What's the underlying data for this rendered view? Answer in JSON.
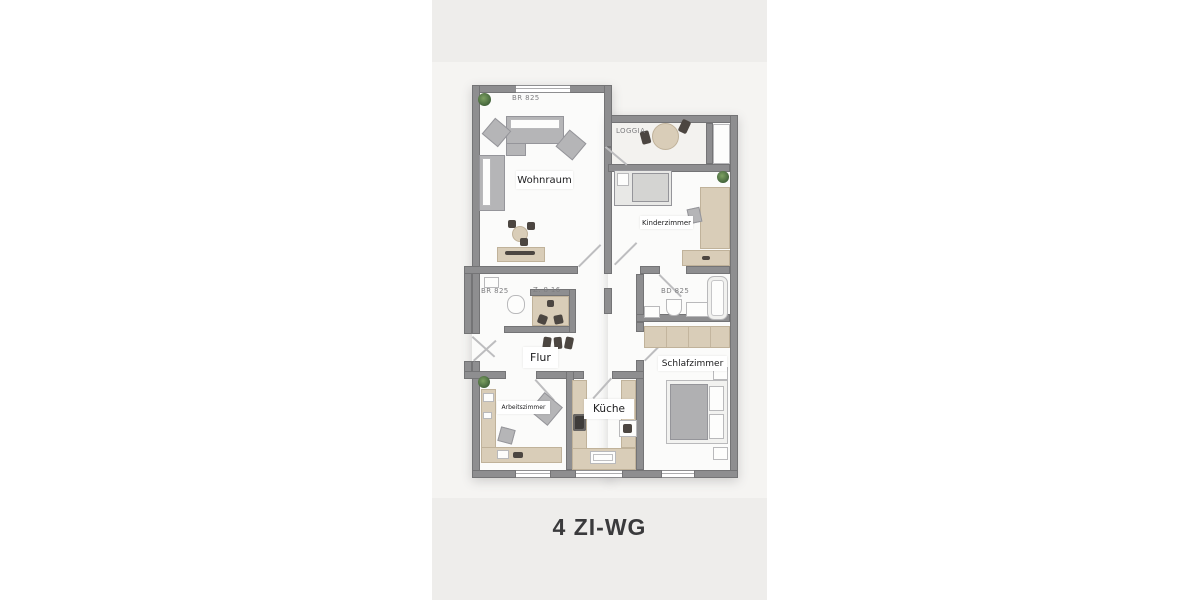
{
  "title": "4 ZI-WG",
  "rooms": {
    "wohnraum": "Wohnraum",
    "kinderzimmer": "Kinderzimmer",
    "flur": "Flur",
    "schlafzimmer": "Schlafzimmer",
    "kueche": "Küche",
    "arbeitszimmer": "Arbeitszimmer"
  },
  "annotations": {
    "loggia": "LOGGIA",
    "br825_top": "BR 825",
    "br825_mid": "BR 825",
    "z816": "Z. 8 16",
    "bd825": "BD 825"
  },
  "colors": {
    "page_bg": "#ffffff",
    "panel_bg": "#eeedeb",
    "plan_bg": "#f5f4f2",
    "wall": "#8e8e90",
    "floor": "#fbfbfa",
    "furniture_beige": "#d9cdb8",
    "furniture_gray": "#b5b5b7",
    "dark_items": "#4c4641",
    "plant_green": "#42633a",
    "label_text": "#1c1c1e",
    "annotation_text": "#7e7e80",
    "title_text": "#3a3a3c"
  }
}
